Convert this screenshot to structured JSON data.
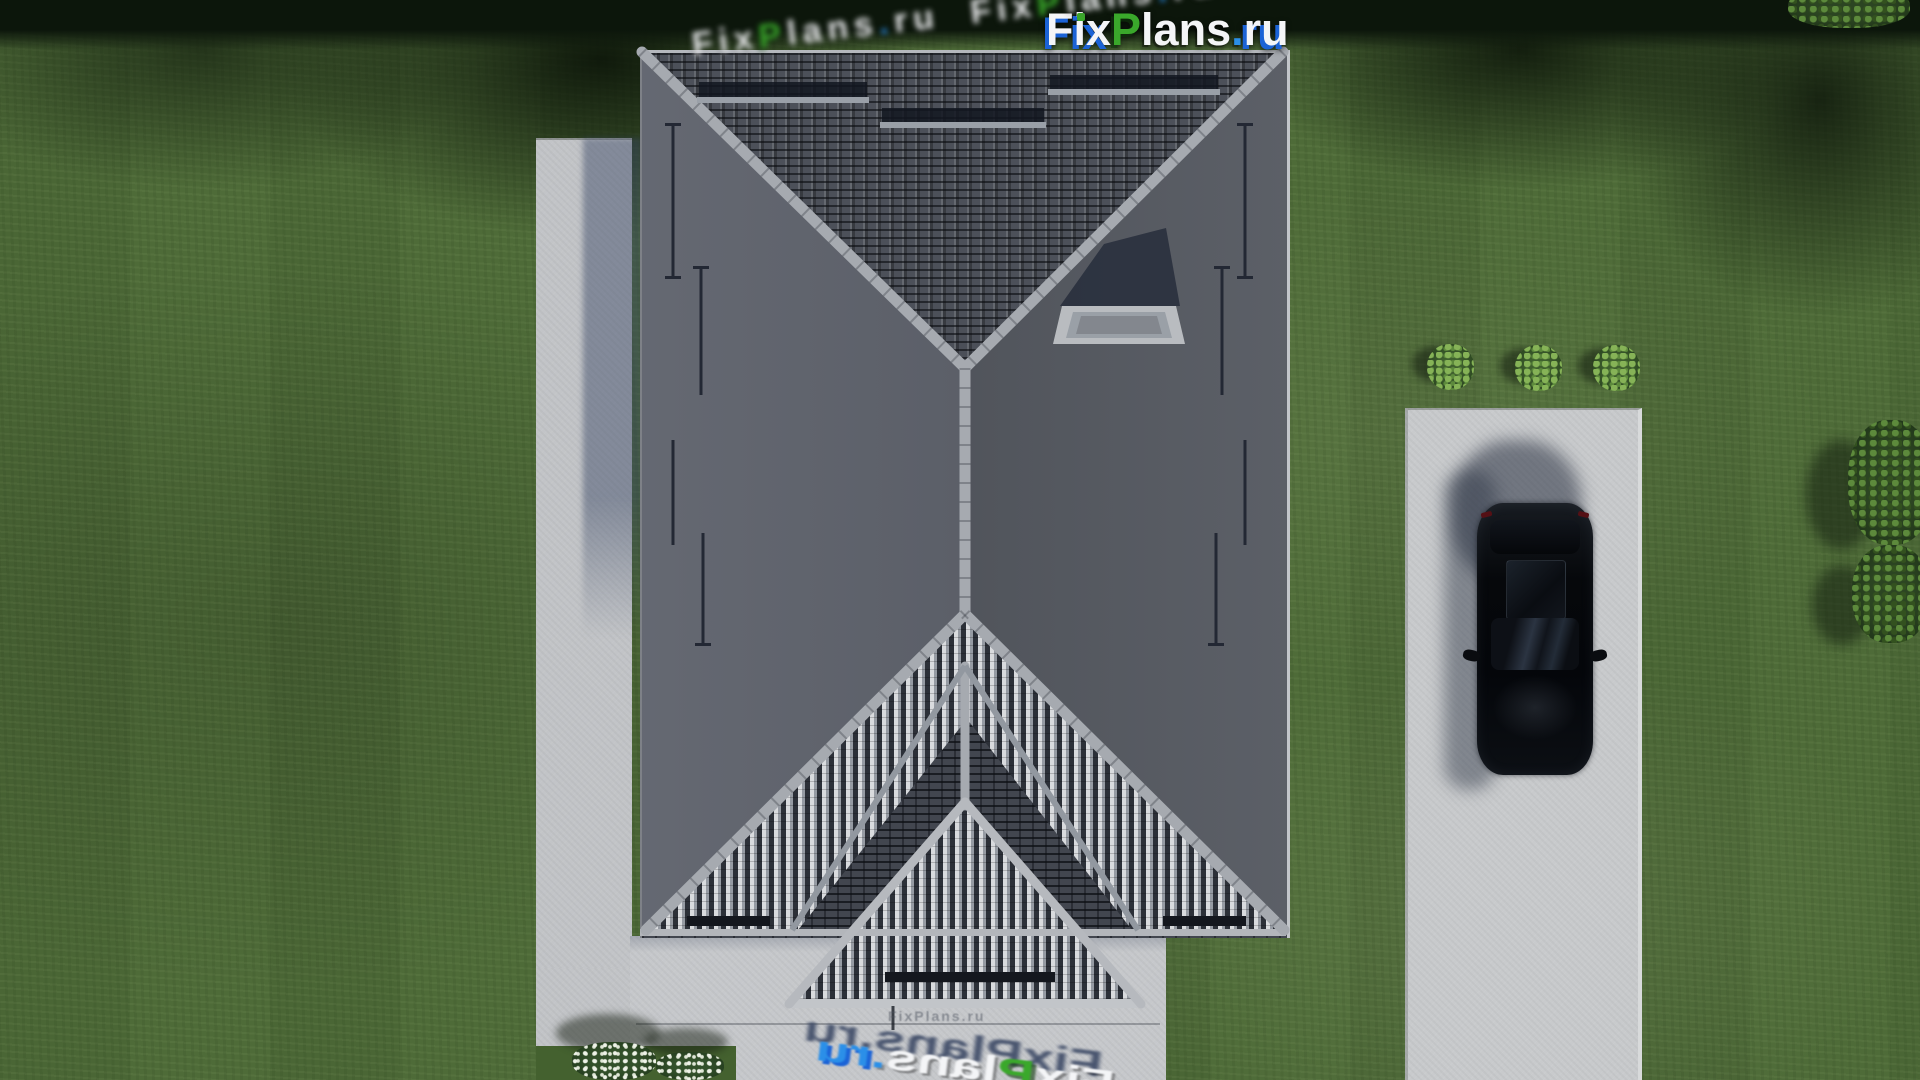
{
  "logo": {
    "full": "FixPlans.ru",
    "fix": "Fix",
    "p": "P",
    "lans": "lans",
    "dot": ".",
    "ru": "ru",
    "colors": {
      "white": "#f4f5f7",
      "green": "#3aa82b",
      "blue": "#1b63d6",
      "dot_blue": "#2b8fe8"
    }
  },
  "watermarks": {
    "stamp": "FixPlans.ru"
  },
  "scene": {
    "grass": "#4e6b38",
    "grass_shadow": "#24361c",
    "concrete": "#c2c4c7",
    "driveway": "#c8cacc",
    "walk_path": "#b9bbbf",
    "roof_north": "#4c5059",
    "roof_west": "#5b5f69",
    "roof_east": "#53575f",
    "roof_south": "#42464f",
    "roof_stripe_light": "#d9dbde",
    "ridge": "#a6aab0",
    "chimney_cap": "#b9bcc0",
    "car": "#07090d",
    "bush": "#3f602e"
  }
}
